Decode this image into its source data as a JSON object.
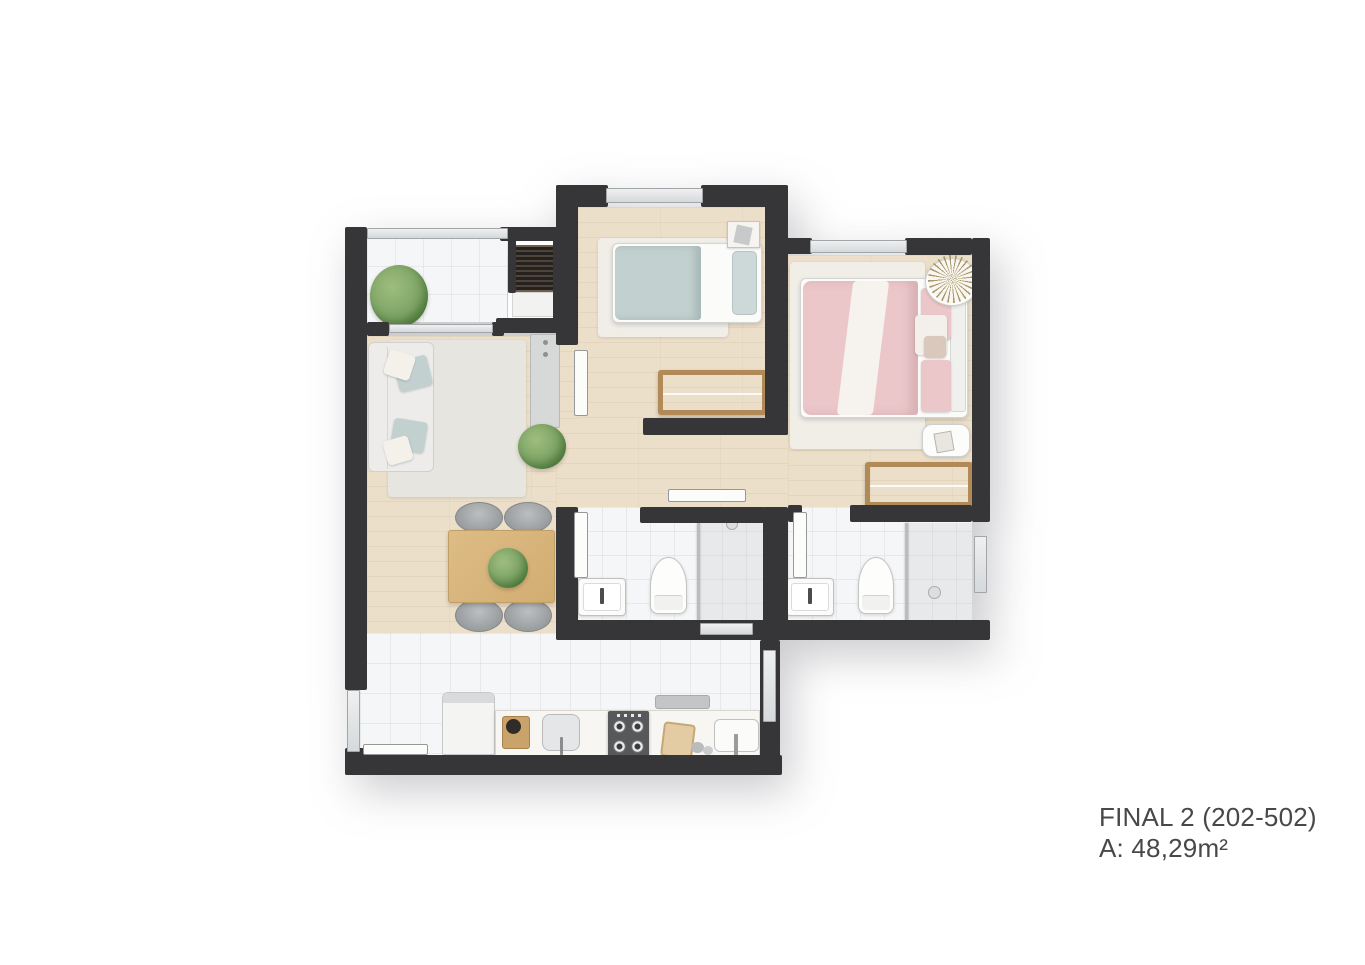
{
  "label": {
    "title": "FINAL 2 (202-502)",
    "area": "A: 48,29m²"
  },
  "colors": {
    "background": "#ffffff",
    "wall": "#363638",
    "wood_floor": "#ecdfc9",
    "tile_floor": "#f5f6f7",
    "rug_living": "#e6e5e0",
    "rug_bedroom": "#f1eee8",
    "teal_bedding": "#c2d1d0",
    "teal_pillow": "#cdd9d8",
    "pink_bedding": "#ecc7ca",
    "table_wood": "#ddbc85",
    "wardrobe_wood": "#b28a58",
    "plant_green": "#7da465",
    "counter": "#f7f6f2",
    "stove_dark": "#57585a"
  }
}
